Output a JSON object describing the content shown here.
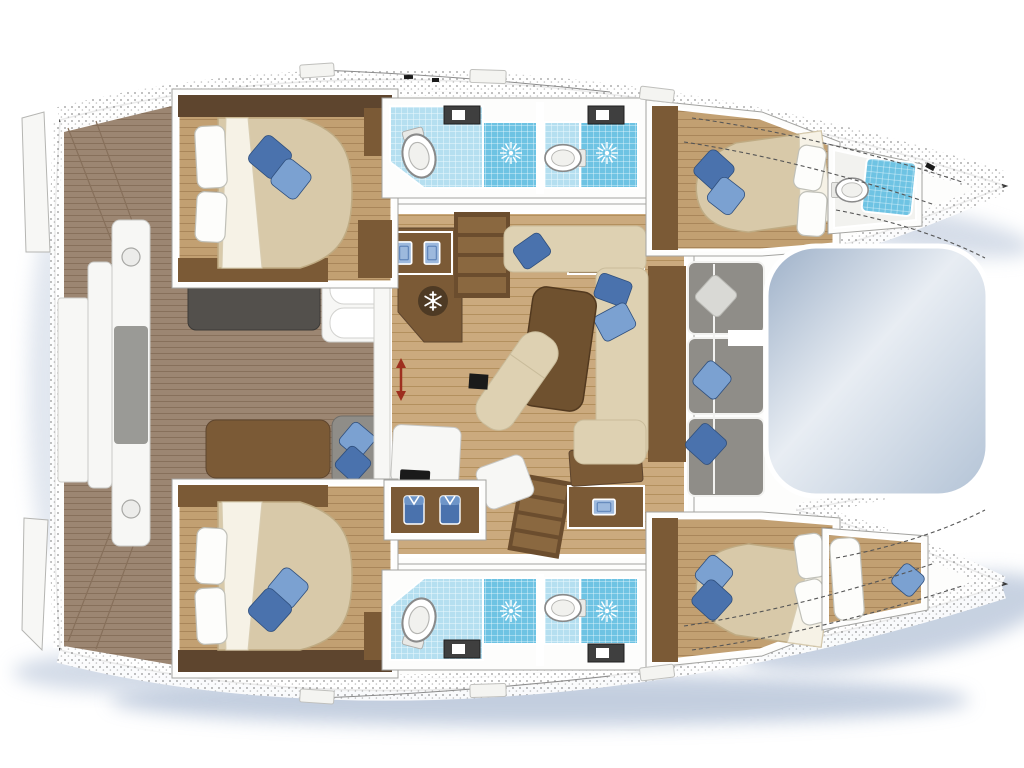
{
  "diagram": {
    "type": "boat-floor-plan",
    "vessel": "catamaran-yacht",
    "orientation_bow": "right",
    "orientation_stern": "left"
  },
  "rooms": [
    "aft-cockpit",
    "port-swim-platform",
    "starboard-swim-platform",
    "port-aft-cabin",
    "port-aft-bathroom",
    "port-forward-bathroom",
    "port-forward-cabin",
    "port-forepeak-head",
    "salon",
    "galley",
    "companionway-stairs-port",
    "companionway-stairs-starboard",
    "starboard-aft-cabin",
    "starboard-wardrobe",
    "starboard-aft-bathroom",
    "starboard-forward-bathroom",
    "starboard-forward-cabin",
    "starboard-forepeak-berth",
    "forward-cockpit",
    "trampoline"
  ],
  "icons": {
    "shower_drain": "sunburst",
    "fridge": "snowflake",
    "toilet": "oval-toilet",
    "wardrobe_contents": "hanging-shirts",
    "sliding_door": "red-double-arrow"
  },
  "colors": {
    "background": "#ffffff",
    "deck_white": "#fdfdfc",
    "outline": "#3a3a3a",
    "inner_line": "#c9c9c9",
    "stipple": "#9f9f9f",
    "teak": "#9c8672",
    "teak_line": "#87705b",
    "salon_wood": "#cbaa7e",
    "salon_line": "#b3905e",
    "cabin_wood": "#c2a072",
    "cabin_line": "#a9865a",
    "furn_brown": "#7b5a36",
    "furn_brown_dark": "#5e452e",
    "table_brown": "#6f512f",
    "stairs_tread": "#8a6840",
    "stairs_rail": "#6b4d2e",
    "mattress": "#d8c9a9",
    "mattress_shade": "#bfab83",
    "sofa_beige": "#ded1b2",
    "sofa_line": "#c9bc9b",
    "pillow_white": "#fdfdfb",
    "pillow_line": "#c0c0b8",
    "blue_dark": "#4a72ad",
    "blue_light": "#7ba1d1",
    "blue_pale": "#9db9dd",
    "gray_sofa": "#8f8d88",
    "gray_bench_dark": "#53504c",
    "gray_cushion_mid": "#9a9a96",
    "pillow_gray": "#d9d9d5",
    "tile_light": "#b5dff0",
    "tile_medium": "#6ec3e3",
    "tile_grid": "#e6f6fc",
    "counter_dark": "#3f3f3f",
    "white_panel": "#f7f7f5",
    "panel_line": "#c6c6c3",
    "tramp_dark": "#9db0c8",
    "tramp_light": "#e8edf3",
    "tramp_mid": "#b3c3d6",
    "shadow_blue": "#b5c3d8",
    "arrow_red": "#9e2f1f",
    "fitting_black": "#1a1a1a"
  }
}
